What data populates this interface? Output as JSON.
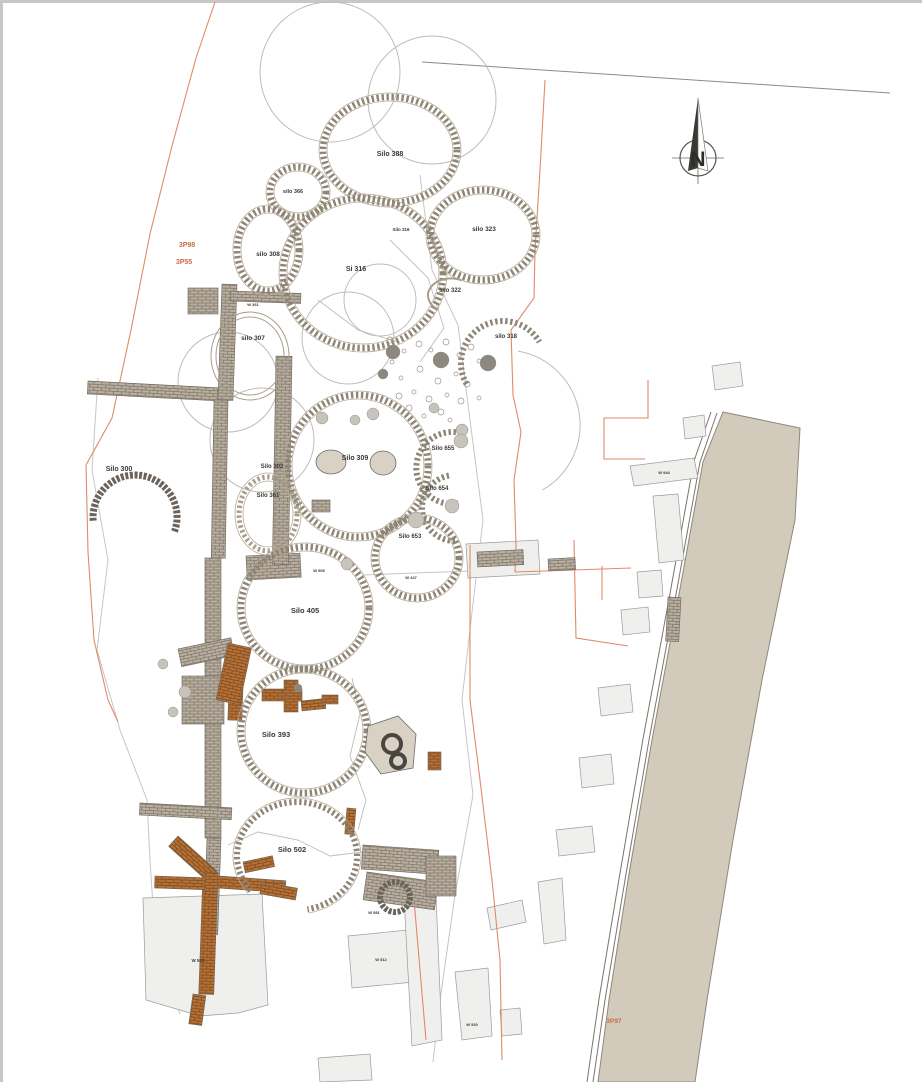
{
  "plan": {
    "width": 922,
    "height": 1082,
    "colors": {
      "ink": "#3b3834",
      "orange_text": "#cf6a48",
      "orange_line": "#e08a66",
      "stone": "#8e8576",
      "stone_light": "#a89d8c",
      "stone_dark": "#6b635a",
      "hairline": "#b3a996",
      "faint": "#bdbdbd",
      "trench": "#c6c6c6",
      "parcel_fill": "#efefed",
      "parcel_stroke": "#9b9b9b",
      "road_fill": "#d2cbbc",
      "road_stroke": "#8e887c",
      "tan": "#d8d1c4",
      "pit_dark": "#8c8880",
      "pit_light": "#c7c3bd",
      "edge": "#c9c7c3",
      "wall_grey_bg": "#b9b0a2",
      "wall_grey_ln": "#7c7365",
      "wall_ochre_bg": "#b4713a",
      "wall_ochre_ln": "#7c4716"
    },
    "north": {
      "cx": 698,
      "cy": 158,
      "r": 18,
      "apex_y": 98,
      "label": "N"
    },
    "labels": [
      {
        "t": "Silo 388",
        "x": 390,
        "y": 156,
        "s": 7
      },
      {
        "t": "silo 366",
        "x": 293,
        "y": 193,
        "s": 5.5
      },
      {
        "t": "silo 308",
        "x": 268,
        "y": 256,
        "s": 6.5
      },
      {
        "t": "Si 316",
        "x": 356,
        "y": 271,
        "s": 7
      },
      {
        "t": "Silo 316",
        "x": 401,
        "y": 231,
        "s": 4.5
      },
      {
        "t": "silo 323",
        "x": 484,
        "y": 231,
        "s": 6.5
      },
      {
        "t": "silo 322",
        "x": 450,
        "y": 292,
        "s": 6
      },
      {
        "t": "silo 318",
        "x": 506,
        "y": 338,
        "s": 6
      },
      {
        "t": "silo 307",
        "x": 253,
        "y": 340,
        "s": 6.5
      },
      {
        "t": "3P98",
        "x": 187,
        "y": 247,
        "s": 7,
        "c": "o"
      },
      {
        "t": "3P55",
        "x": 184,
        "y": 264,
        "s": 7,
        "c": "o"
      },
      {
        "t": "Silo 300",
        "x": 119,
        "y": 471,
        "s": 7
      },
      {
        "t": "Silo 302",
        "x": 272,
        "y": 468,
        "s": 6
      },
      {
        "t": "Silo 361",
        "x": 268,
        "y": 497,
        "s": 6
      },
      {
        "t": "Silo 309",
        "x": 355,
        "y": 460,
        "s": 7
      },
      {
        "t": "Silo 655",
        "x": 443,
        "y": 450,
        "s": 6
      },
      {
        "t": "Silo 654",
        "x": 437,
        "y": 490,
        "s": 6
      },
      {
        "t": "Silo 653",
        "x": 410,
        "y": 538,
        "s": 6
      },
      {
        "t": "Silo 405",
        "x": 305,
        "y": 613,
        "s": 7.5
      },
      {
        "t": "Silo 393",
        "x": 276,
        "y": 737,
        "s": 7.5
      },
      {
        "t": "Silo 502",
        "x": 292,
        "y": 852,
        "s": 7.5
      },
      {
        "t": "3P97",
        "x": 614,
        "y": 1023,
        "s": 6.5,
        "c": "o"
      },
      {
        "t": "W 361",
        "x": 253,
        "y": 306,
        "s": 4
      },
      {
        "t": "W 905",
        "x": 319,
        "y": 572,
        "s": 4
      },
      {
        "t": "W 447",
        "x": 411,
        "y": 579,
        "s": 4
      },
      {
        "t": "W 581",
        "x": 374,
        "y": 914,
        "s": 4
      },
      {
        "t": "W 525",
        "x": 198,
        "y": 962,
        "s": 4.5
      },
      {
        "t": "W 512",
        "x": 381,
        "y": 961,
        "s": 4
      },
      {
        "t": "W 520",
        "x": 472,
        "y": 1026,
        "s": 4
      },
      {
        "t": "W 944",
        "x": 664,
        "y": 474,
        "s": 4
      }
    ],
    "silos": [
      {
        "name": "silo-388",
        "cx": 390,
        "cy": 150,
        "rx": 67,
        "ry": 53,
        "kind": "stone"
      },
      {
        "name": "silo-366",
        "cx": 298,
        "cy": 192,
        "rx": 28,
        "ry": 25,
        "kind": "stone"
      },
      {
        "name": "silo-308",
        "cx": 268,
        "cy": 250,
        "rx": 31,
        "ry": 41,
        "kind": "stone"
      },
      {
        "name": "silo-316",
        "cx": 363,
        "cy": 273,
        "rx": 80,
        "ry": 75,
        "kind": "stone"
      },
      {
        "name": "silo-323",
        "cx": 483,
        "cy": 235,
        "rx": 53,
        "ry": 45,
        "kind": "stone"
      },
      {
        "name": "silo-322",
        "cx": 450,
        "cy": 295,
        "rx": 23,
        "ry": 17,
        "kind": "thinarc",
        "a1": 120,
        "a2": 300
      },
      {
        "name": "silo-318",
        "cx": 503,
        "cy": 363,
        "rx": 42,
        "ry": 42,
        "kind": "arc",
        "a1": 150,
        "a2": 330
      },
      {
        "name": "silo-307",
        "cx": 250,
        "cy": 356,
        "rx": 39,
        "ry": 44,
        "kind": "thin"
      },
      {
        "name": "silo-309",
        "cx": 358,
        "cy": 466,
        "rx": 70,
        "ry": 71,
        "kind": "stone"
      },
      {
        "name": "silo-361",
        "cx": 268,
        "cy": 514,
        "rx": 29,
        "ry": 37,
        "kind": "stone_light"
      },
      {
        "name": "silo-655",
        "cx": 452,
        "cy": 468,
        "rx": 36,
        "ry": 36,
        "kind": "arc",
        "a1": 80,
        "a2": 280
      },
      {
        "name": "silo-654",
        "cx": 455,
        "cy": 508,
        "rx": 33,
        "ry": 33,
        "kind": "arc",
        "a1": 90,
        "a2": 260
      },
      {
        "name": "silo-653",
        "cx": 417,
        "cy": 558,
        "rx": 42,
        "ry": 40,
        "kind": "stone"
      },
      {
        "name": "silo-300",
        "cx": 135,
        "cy": 517,
        "rx": 42,
        "ry": 42,
        "kind": "arcdark",
        "a1": 175,
        "a2": 380
      },
      {
        "name": "silo-405",
        "cx": 305,
        "cy": 608,
        "rx": 64,
        "ry": 61,
        "kind": "stone"
      },
      {
        "name": "silo-393",
        "cx": 304,
        "cy": 731,
        "rx": 63,
        "ry": 62,
        "kind": "stone"
      },
      {
        "name": "silo-502",
        "cx": 297,
        "cy": 856,
        "rx": 60,
        "ry": 54,
        "kind": "arcstone",
        "a1": 140,
        "a2": 440
      },
      {
        "name": "well-ring",
        "cx": 395,
        "cy": 897,
        "rx": 15,
        "ry": 15,
        "kind": "dark"
      }
    ],
    "faint_circles": [
      [
        330,
        72,
        70
      ],
      [
        432,
        100,
        64
      ],
      [
        348,
        338,
        46
      ],
      [
        262,
        440,
        52
      ],
      [
        228,
        382,
        50
      ],
      [
        380,
        300,
        36
      ]
    ],
    "faint_arcs": [
      [
        505,
        425,
        75,
        -80,
        60
      ]
    ],
    "faint_lines": [
      "228,845 258,832 298,840 330,856 362,852 390,864",
      "352,678 360,714 350,756 366,800 358,830",
      "390,240 428,278 444,328 420,362",
      "318,300 358,330 398,342"
    ],
    "trench_outlines": [
      "98,378 92,470 108,560 97,650 120,730 147,800 150,860 153,906",
      "420,175 432,270 458,325 470,420 483,520 472,612 462,700 473,795 455,895 440,1000 433,1062",
      "153,906 162,964 180,1014",
      "362,575 470,571",
      "470,571 516,569"
    ],
    "grey_lines": [
      "422,62 890,93"
    ],
    "orange_lines": [
      "215,2 196,58 172,146 150,234 131,330 112,418 86,465 88,552 94,640 108,700 118,722",
      "545,80 540,170 535,250 534,298 511,330 513,395 521,432 514,480 516,545 515,572",
      "515,572 631,568",
      "574,540 576,638 628,646",
      "470,545 470,700 480,780 492,880 500,960 502,1060",
      "648,380 648,418 604,418 604,459 645,459",
      "602,566 602,600",
      "414,900 426,1040"
    ],
    "road": {
      "points": "723,412 800,428 795,520 762,680 733,840 707,1000 695,1082 598,1082 609,1000 628,880 652,740 678,600 703,462"
    },
    "kerbs": [
      "717,413 700,462 675,600 649,740 625,880 605,1000 593,1082",
      "711,412 694,461 669,599 643,739 619,879 599,999 587,1082"
    ],
    "parcels": [
      "712,366 740,362 743,386 715,390",
      "683,418 704,415 706,436 685,439",
      "630,466 694,458 698,478 634,486",
      "653,496 678,494 684,560 659,563",
      "637,572 661,570 663,596 639,598",
      "621,610 648,607 650,632 623,635",
      "598,688 630,684 633,712 601,716",
      "579,758 611,754 614,784 582,788",
      "556,830 592,826 595,852 559,856",
      "538,882 562,878 566,940 544,944",
      "487,908 522,900 526,922 491,930",
      "455,972 488,968 492,1036 462,1040",
      "500,1010 520,1008 522,1034 502,1036",
      "348,936 408,930 414,982 352,988",
      "404,898 436,896 442,1040 412,1046",
      "143,898 262,894 268,1005 238,1013 200,1016 146,1000",
      "466,544 538,540 540,574 468,578",
      "318,1058 370,1054 372,1080 320,1082"
    ],
    "rubble_rects": [
      [
        477,
        552,
        46,
        15,
        -3
      ],
      [
        548,
        559,
        27,
        12,
        -3
      ],
      [
        668,
        597,
        13,
        44,
        3
      ],
      [
        246,
        556,
        54,
        24,
        -3
      ],
      [
        312,
        500,
        18,
        12,
        0
      ]
    ],
    "walls_grey": [
      [
        88,
        381,
        130,
        13,
        3
      ],
      [
        222,
        284,
        15,
        116,
        2
      ],
      [
        214,
        400,
        14,
        158,
        1
      ],
      [
        276,
        356,
        16,
        208,
        1
      ],
      [
        205,
        558,
        16,
        280,
        0
      ],
      [
        231,
        291,
        70,
        10,
        2
      ],
      [
        140,
        803,
        92,
        12,
        3
      ],
      [
        207,
        838,
        14,
        96,
        2
      ],
      [
        178,
        649,
        54,
        18,
        -12
      ],
      [
        182,
        676,
        42,
        48,
        0
      ],
      [
        363,
        845,
        76,
        24,
        4
      ],
      [
        367,
        872,
        72,
        28,
        8
      ],
      [
        426,
        856,
        30,
        40,
        0
      ],
      [
        188,
        288,
        30,
        26,
        0
      ]
    ],
    "walls_ochre": [
      [
        178,
        836,
        52,
        14,
        42
      ],
      [
        203,
        872,
        15,
        122,
        2
      ],
      [
        218,
        876,
        68,
        12,
        4
      ],
      [
        243,
        862,
        30,
        11,
        -12
      ],
      [
        262,
        882,
        36,
        12,
        10
      ],
      [
        230,
        658,
        14,
        62,
        2
      ],
      [
        262,
        689,
        40,
        12,
        0
      ],
      [
        284,
        680,
        14,
        32,
        0
      ],
      [
        301,
        701,
        24,
        10,
        -6
      ],
      [
        228,
        643,
        24,
        58,
        12
      ],
      [
        347,
        808,
        9,
        26,
        5
      ],
      [
        428,
        752,
        13,
        18,
        0
      ],
      [
        193,
        994,
        13,
        30,
        8
      ],
      [
        322,
        695,
        16,
        9,
        0
      ],
      [
        155,
        876,
        50,
        12,
        2
      ]
    ],
    "pits": [
      [
        393,
        352,
        7,
        "d"
      ],
      [
        441,
        360,
        8,
        "d"
      ],
      [
        488,
        363,
        8,
        "d"
      ],
      [
        383,
        374,
        5,
        "d"
      ],
      [
        373,
        414,
        6,
        "l"
      ],
      [
        434,
        408,
        5,
        "l"
      ],
      [
        462,
        430,
        6,
        "l"
      ],
      [
        416,
        520,
        8,
        "l"
      ],
      [
        452,
        506,
        7,
        "l"
      ],
      [
        461,
        441,
        7,
        "l"
      ],
      [
        347,
        564,
        6,
        "l"
      ],
      [
        185,
        692,
        6,
        "l"
      ],
      [
        173,
        712,
        5,
        "l"
      ],
      [
        163,
        664,
        5,
        "l"
      ],
      [
        298,
        688,
        4,
        "d"
      ],
      [
        322,
        418,
        6,
        "l"
      ],
      [
        355,
        420,
        5,
        "l"
      ]
    ],
    "pebbles": [
      [
        390,
        340
      ],
      [
        404,
        351
      ],
      [
        419,
        344
      ],
      [
        431,
        350
      ],
      [
        446,
        342
      ],
      [
        459,
        355
      ],
      [
        471,
        347
      ],
      [
        479,
        361
      ],
      [
        420,
        369
      ],
      [
        401,
        378
      ],
      [
        438,
        381
      ],
      [
        456,
        374
      ],
      [
        467,
        384
      ],
      [
        414,
        392
      ],
      [
        429,
        399
      ],
      [
        447,
        395
      ],
      [
        461,
        401
      ],
      [
        479,
        398
      ],
      [
        409,
        408
      ],
      [
        424,
        416
      ],
      [
        441,
        412
      ],
      [
        392,
        362
      ],
      [
        399,
        396
      ],
      [
        450,
        420
      ]
    ],
    "tan_ellipses": [
      [
        331,
        462,
        15,
        12
      ],
      [
        383,
        463,
        13,
        12
      ]
    ],
    "tan_polygon": "368,726 398,716 416,734 413,768 381,774 365,752",
    "tan_rings": [
      [
        392,
        744,
        9
      ],
      [
        398,
        761,
        7
      ]
    ]
  }
}
